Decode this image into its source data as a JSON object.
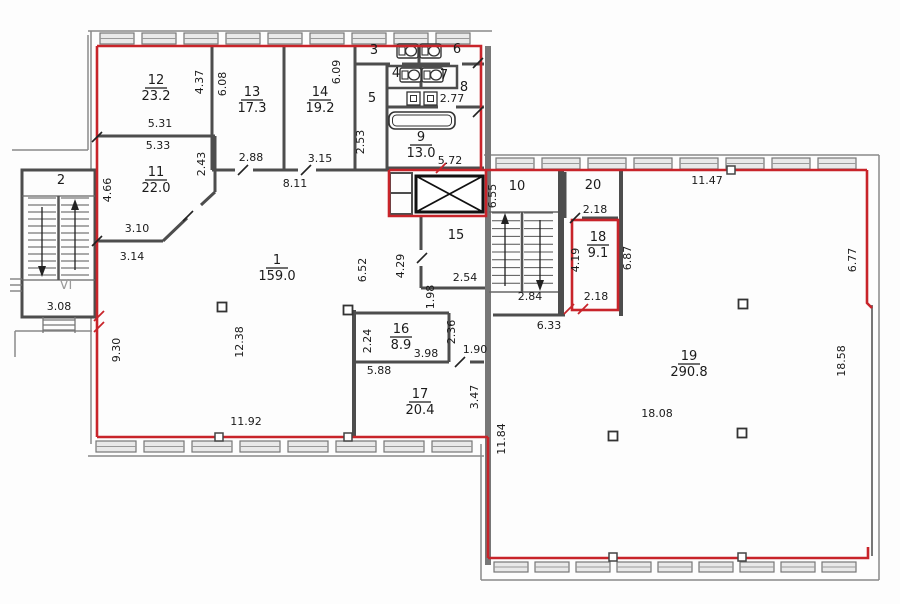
{
  "plan": {
    "colors": {
      "boundary_red": "#c8242a",
      "wall_gray": "#4d4d4d",
      "light_gray": "#8a8a8a",
      "text": "#1b1b1b"
    },
    "rooms": [
      {
        "number": "1",
        "area": "159.0",
        "x": 277,
        "y": 264
      },
      {
        "number": "2",
        "area": null,
        "x": 61,
        "y": 184
      },
      {
        "number": "3",
        "area": null,
        "x": 374,
        "y": 54
      },
      {
        "number": "4",
        "area": null,
        "x": 396,
        "y": 77
      },
      {
        "number": "5",
        "area": null,
        "x": 372,
        "y": 102
      },
      {
        "number": "6",
        "area": null,
        "x": 457,
        "y": 53
      },
      {
        "number": "7",
        "area": null,
        "x": 444,
        "y": 79
      },
      {
        "number": "8",
        "area": null,
        "x": 464,
        "y": 91
      },
      {
        "number": "9",
        "area": "13.0",
        "x": 421,
        "y": 141
      },
      {
        "number": "10",
        "area": null,
        "x": 517,
        "y": 190
      },
      {
        "number": "11",
        "area": "22.0",
        "x": 156,
        "y": 176
      },
      {
        "number": "12",
        "area": "23.2",
        "x": 156,
        "y": 84
      },
      {
        "number": "13",
        "area": "17.3",
        "x": 252,
        "y": 96
      },
      {
        "number": "14",
        "area": "19.2",
        "x": 320,
        "y": 96
      },
      {
        "number": "15",
        "area": null,
        "x": 456,
        "y": 239
      },
      {
        "number": "16",
        "area": "8.9",
        "x": 401,
        "y": 333
      },
      {
        "number": "17",
        "area": "20.4",
        "x": 420,
        "y": 398
      },
      {
        "number": "18",
        "area": "9.1",
        "x": 598,
        "y": 241
      },
      {
        "number": "19",
        "area": "290.8",
        "x": 689,
        "y": 360
      },
      {
        "number": "20",
        "area": null,
        "x": 593,
        "y": 189
      }
    ],
    "dimensions": [
      {
        "text": "4.37",
        "x": 203,
        "y": 82,
        "v": true
      },
      {
        "text": "6.08",
        "x": 226,
        "y": 84,
        "v": true
      },
      {
        "text": "6.09",
        "x": 340,
        "y": 72,
        "v": true
      },
      {
        "text": "5.31",
        "x": 160,
        "y": 127,
        "v": false
      },
      {
        "text": "5.33",
        "x": 158,
        "y": 149,
        "v": false
      },
      {
        "text": "2.43",
        "x": 205,
        "y": 164,
        "v": true
      },
      {
        "text": "4.66",
        "x": 111,
        "y": 190,
        "v": true
      },
      {
        "text": "2.88",
        "x": 251,
        "y": 161,
        "v": false
      },
      {
        "text": "3.15",
        "x": 320,
        "y": 162,
        "v": false
      },
      {
        "text": "8.11",
        "x": 295,
        "y": 187,
        "v": false
      },
      {
        "text": "3.10",
        "x": 137,
        "y": 232,
        "v": false
      },
      {
        "text": "3.14",
        "x": 132,
        "y": 260,
        "v": false
      },
      {
        "text": "2.53",
        "x": 364,
        "y": 142,
        "v": true
      },
      {
        "text": "2.77",
        "x": 452,
        "y": 102,
        "v": false
      },
      {
        "text": "5.72",
        "x": 450,
        "y": 164,
        "v": false
      },
      {
        "text": "9.30",
        "x": 120,
        "y": 350,
        "v": true
      },
      {
        "text": "12.38",
        "x": 243,
        "y": 342,
        "v": true
      },
      {
        "text": "6.52",
        "x": 366,
        "y": 270,
        "v": true
      },
      {
        "text": "11.92",
        "x": 246,
        "y": 425,
        "v": false
      },
      {
        "text": "4.29",
        "x": 404,
        "y": 266,
        "v": true
      },
      {
        "text": "1.98",
        "x": 434,
        "y": 297,
        "v": true
      },
      {
        "text": "2.54",
        "x": 465,
        "y": 281,
        "v": false
      },
      {
        "text": "2.84",
        "x": 530,
        "y": 300,
        "v": false
      },
      {
        "text": "6.55",
        "x": 496,
        "y": 196,
        "v": true
      },
      {
        "text": "2.24",
        "x": 371,
        "y": 341,
        "v": true
      },
      {
        "text": "3.98",
        "x": 426,
        "y": 357,
        "v": false
      },
      {
        "text": "2.36",
        "x": 455,
        "y": 332,
        "v": true
      },
      {
        "text": "1.90",
        "x": 475,
        "y": 353,
        "v": false
      },
      {
        "text": "5.88",
        "x": 379,
        "y": 374,
        "v": false
      },
      {
        "text": "3.47",
        "x": 478,
        "y": 397,
        "v": true
      },
      {
        "text": "11.84",
        "x": 505,
        "y": 439,
        "v": true
      },
      {
        "text": "6.33",
        "x": 549,
        "y": 329,
        "v": false
      },
      {
        "text": "2.18",
        "x": 595,
        "y": 213,
        "v": false
      },
      {
        "text": "4.19",
        "x": 579,
        "y": 260,
        "v": true
      },
      {
        "text": "2.18",
        "x": 596,
        "y": 300,
        "v": false
      },
      {
        "text": "6.87",
        "x": 631,
        "y": 258,
        "v": true
      },
      {
        "text": "11.47",
        "x": 707,
        "y": 184,
        "v": false
      },
      {
        "text": "6.77",
        "x": 856,
        "y": 260,
        "v": true
      },
      {
        "text": "18.58",
        "x": 845,
        "y": 361,
        "v": true
      },
      {
        "text": "18.08",
        "x": 657,
        "y": 417,
        "v": false
      },
      {
        "text": "3.08",
        "x": 59,
        "y": 310,
        "v": false
      }
    ],
    "annotations": [
      {
        "text": "VI",
        "x": 66,
        "y": 289
      }
    ]
  }
}
